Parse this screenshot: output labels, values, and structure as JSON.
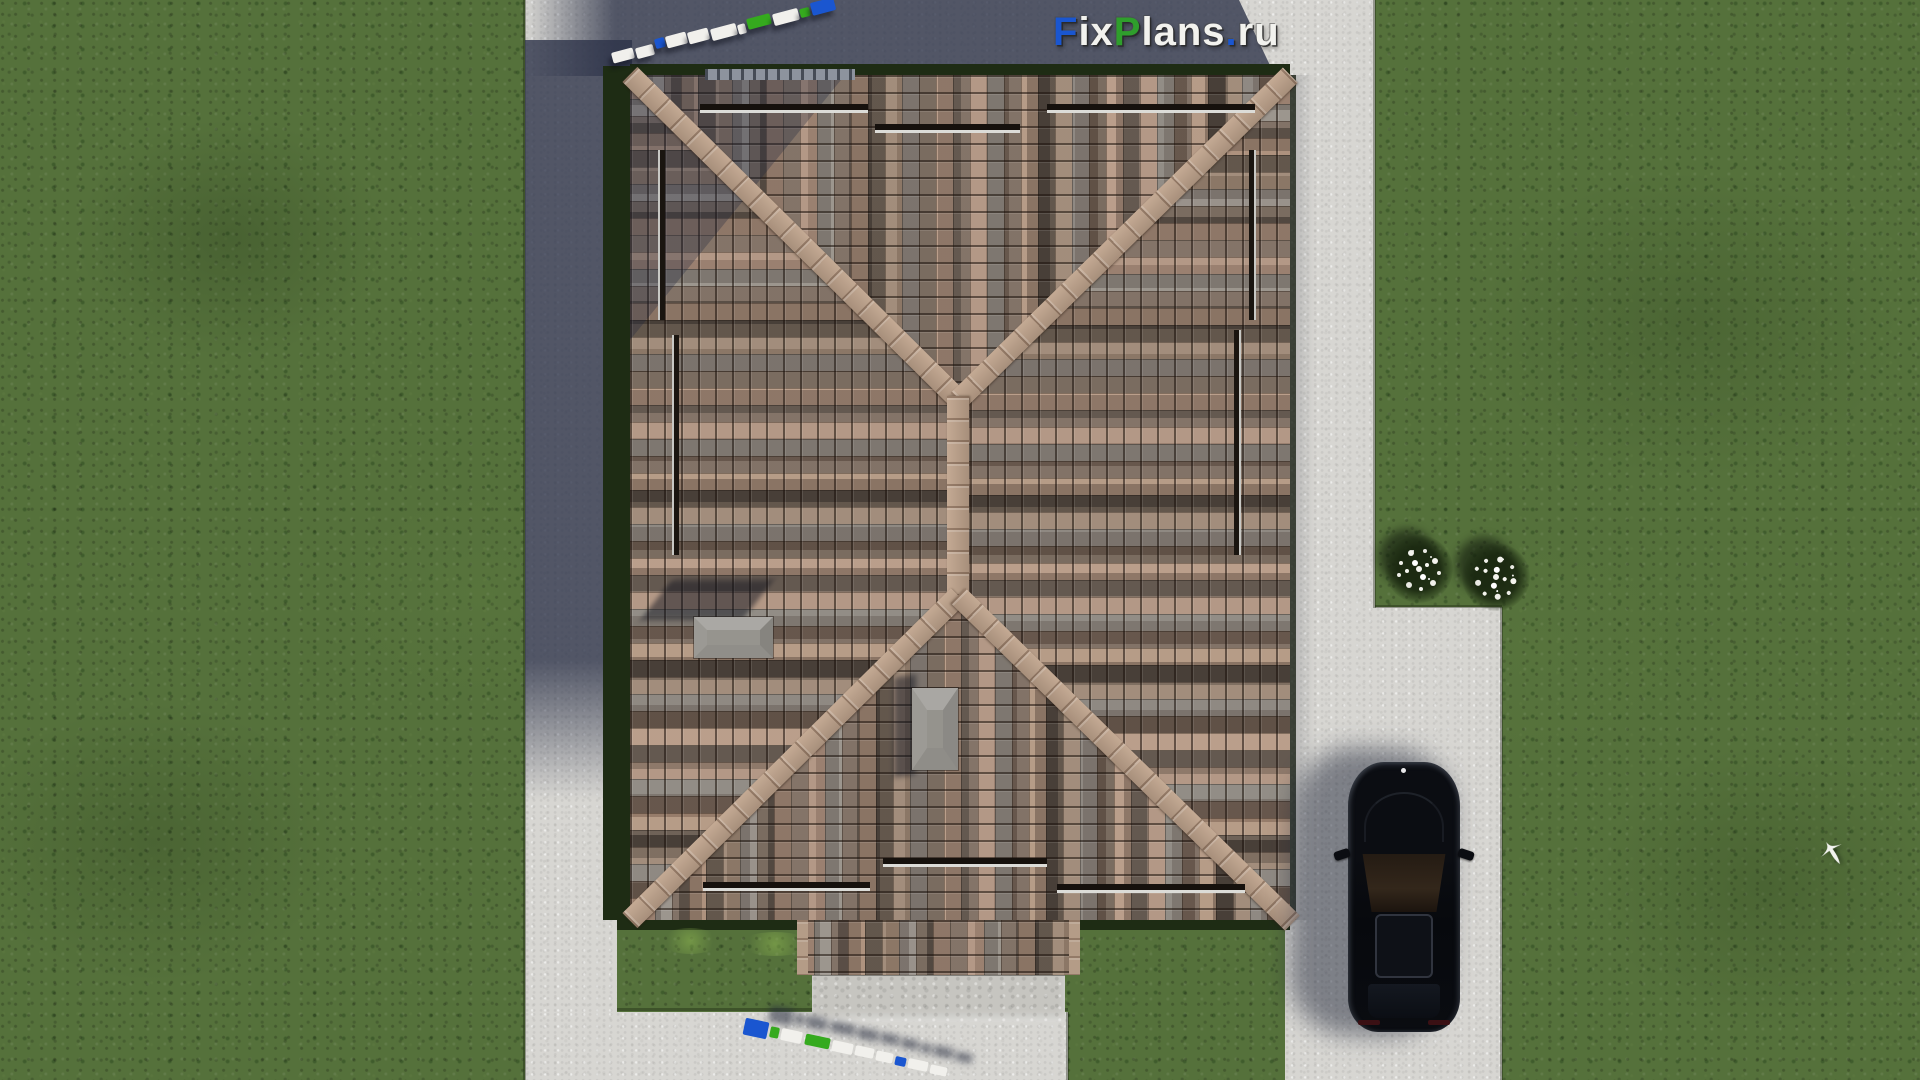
{
  "watermark": {
    "full_text": "FixPlans.ru",
    "segments": [
      {
        "text": "F",
        "color": "#1a56d0"
      },
      {
        "text": "ix",
        "color": "#f2f2ee"
      },
      {
        "text": "P",
        "color": "#2f9e2c"
      },
      {
        "text": "lans",
        "color": "#f2f2ee"
      },
      {
        "text": ".",
        "color": "#1a56d0"
      },
      {
        "text": "ru",
        "color": "#f2f2ee"
      }
    ]
  },
  "palette": {
    "grass": "#55713b",
    "concrete_path": "#d7d6d2",
    "shadow_tint": "#2c3248",
    "roof_tile_tan": "#b69a88",
    "roof_tile_gray": "#8e8c88",
    "roof_tile_dark": "#544a42",
    "roof_ridge": "#b49c87",
    "hedge_dark_green": "#1e2c14",
    "chimney_cap_gray": "#96948e",
    "car_body_black": "#0a0c10",
    "logo_w": "#f1f0ec",
    "logo_b": "#1a56d0",
    "logo_g": "#35aa1e",
    "flower_white": "#f4f4ee"
  },
  "logo3d_top": {
    "rotation_deg": -15,
    "blocks": [
      {
        "x": 612,
        "y": 50,
        "w": 22,
        "h": 11,
        "c": "w"
      },
      {
        "x": 636,
        "y": 46,
        "w": 18,
        "h": 11,
        "c": "w"
      },
      {
        "x": 655,
        "y": 38,
        "w": 10,
        "h": 10,
        "c": "b"
      },
      {
        "x": 666,
        "y": 34,
        "w": 21,
        "h": 12,
        "c": "w"
      },
      {
        "x": 688,
        "y": 30,
        "w": 21,
        "h": 12,
        "c": "w"
      },
      {
        "x": 711,
        "y": 26,
        "w": 26,
        "h": 12,
        "c": "w"
      },
      {
        "x": 738,
        "y": 24,
        "w": 8,
        "h": 10,
        "c": "w"
      },
      {
        "x": 747,
        "y": 16,
        "w": 24,
        "h": 11,
        "c": "g"
      },
      {
        "x": 773,
        "y": 11,
        "w": 26,
        "h": 12,
        "c": "w"
      },
      {
        "x": 800,
        "y": 8,
        "w": 10,
        "h": 9,
        "c": "g"
      },
      {
        "x": 811,
        "y": 0,
        "w": 24,
        "h": 13,
        "c": "b"
      }
    ]
  },
  "logo3d_bottom": {
    "rotation_deg": 12,
    "blocks": [
      {
        "x": 744,
        "y": 1020,
        "w": 24,
        "h": 17,
        "c": "b"
      },
      {
        "x": 770,
        "y": 1027,
        "w": 9,
        "h": 11,
        "c": "g"
      },
      {
        "x": 781,
        "y": 1030,
        "w": 21,
        "h": 12,
        "c": "w"
      },
      {
        "x": 805,
        "y": 1036,
        "w": 25,
        "h": 11,
        "c": "g"
      },
      {
        "x": 832,
        "y": 1042,
        "w": 21,
        "h": 11,
        "c": "w"
      },
      {
        "x": 855,
        "y": 1047,
        "w": 19,
        "h": 10,
        "c": "w"
      },
      {
        "x": 876,
        "y": 1052,
        "w": 17,
        "h": 10,
        "c": "w"
      },
      {
        "x": 895,
        "y": 1057,
        "w": 11,
        "h": 9,
        "c": "b"
      },
      {
        "x": 908,
        "y": 1060,
        "w": 20,
        "h": 10,
        "c": "w"
      },
      {
        "x": 930,
        "y": 1066,
        "w": 17,
        "h": 9,
        "c": "w"
      }
    ]
  },
  "flower_clusters": [
    {
      "x": 1385,
      "y": 535
    },
    {
      "x": 1462,
      "y": 543
    }
  ]
}
